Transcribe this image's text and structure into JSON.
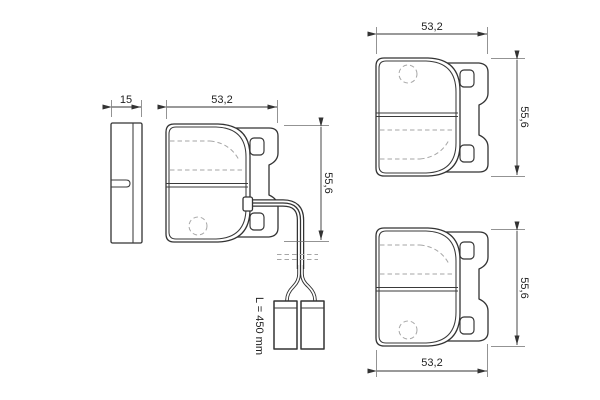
{
  "drawing": {
    "description": "Technical drawing of disc brake pad set, three pad views plus side thickness view, with wear sensor wire",
    "background_color": "#ffffff",
    "line_color": "#333333",
    "dashed_line_color": "#a6a6a6",
    "views": {
      "side": {
        "thickness": "15"
      },
      "front": {
        "width": "53,2",
        "height": "55,6",
        "wire_label": "L = 450 mm"
      },
      "rear_top": {
        "width": "53,2",
        "height": "55,6"
      },
      "rear_bottom": {
        "width": "53,2",
        "height": "55,6"
      }
    }
  }
}
